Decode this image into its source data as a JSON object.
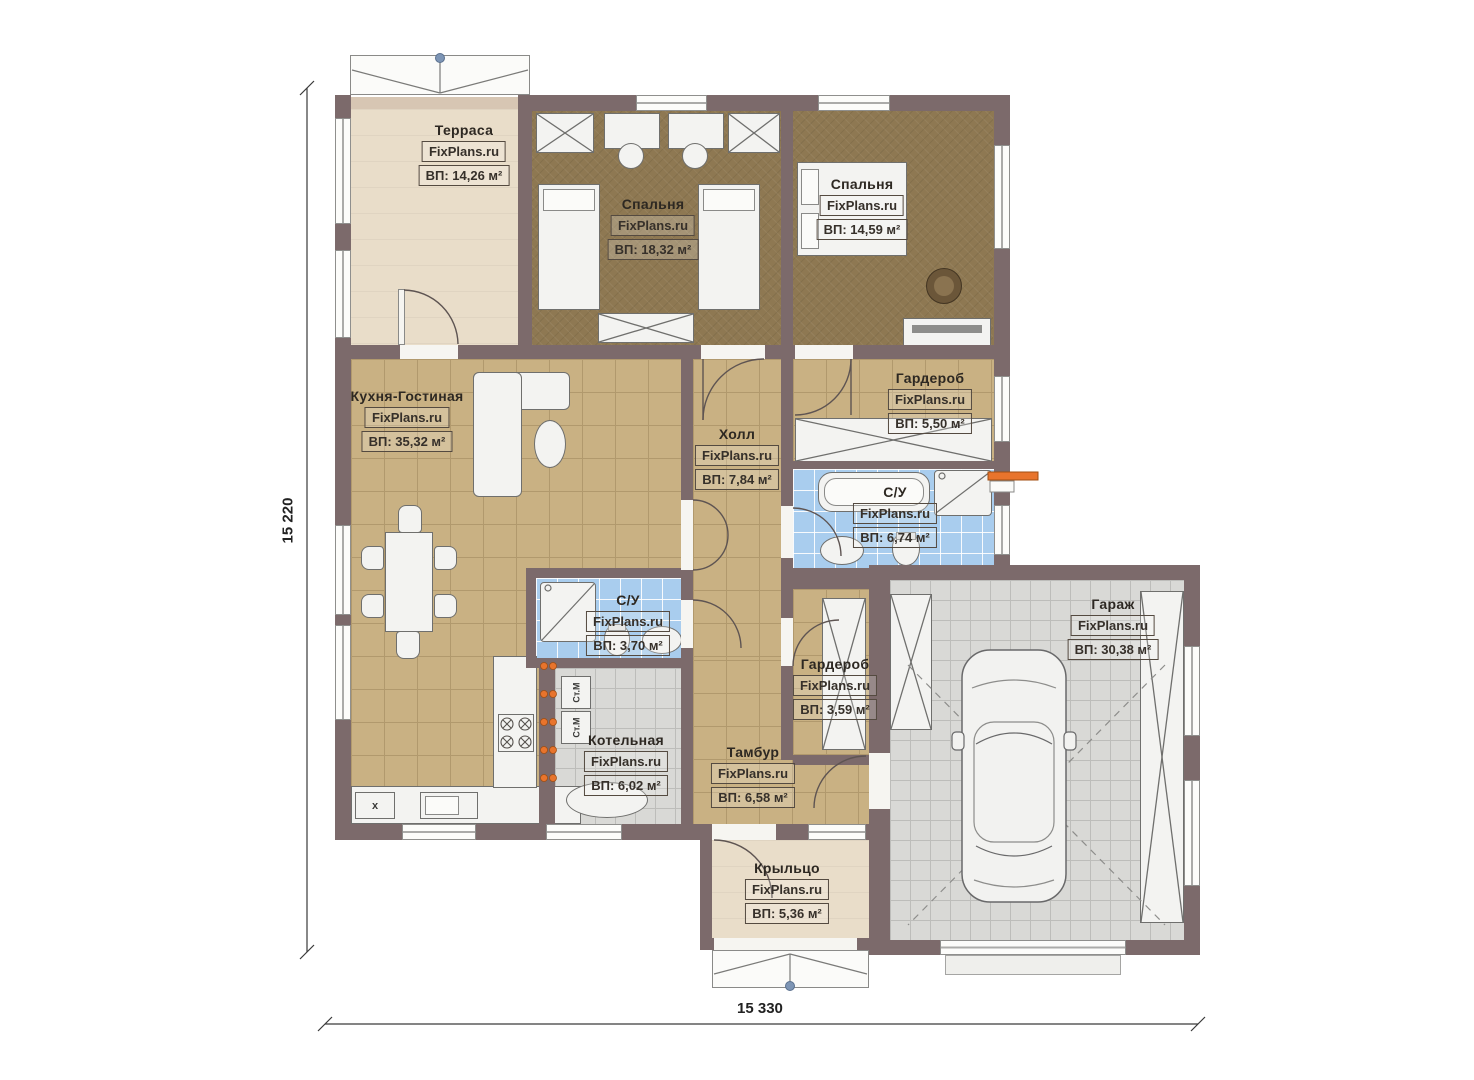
{
  "watermark": "FixPlans.ru",
  "dimensions": {
    "left": "15 220",
    "bottom": "15 330"
  },
  "rooms": {
    "terrace": {
      "label": "Терраса",
      "area": "ВП: 14,26 м²"
    },
    "bedroom1": {
      "label": "Спальня",
      "area": "ВП: 18,32 м²"
    },
    "bedroom2": {
      "label": "Спальня",
      "area": "ВП: 14,59 м²"
    },
    "kitchen_living": {
      "label": "Кухня-Гостиная",
      "area": "ВП: 35,32 м²"
    },
    "hall": {
      "label": "Холл",
      "area": "ВП: 7,84 м²"
    },
    "wardrobe_top": {
      "label": "Гардероб",
      "area": "ВП: 5,50 м²"
    },
    "bathroom_main": {
      "label": "С/У",
      "area": "ВП: 6,74 м²"
    },
    "bathroom_small": {
      "label": "С/У",
      "area": "ВП: 3,70 м²"
    },
    "wardrobe_bottom": {
      "label": "Гардероб",
      "area": "ВП: 3,59 м²"
    },
    "boiler": {
      "label": "Котельная",
      "area": "ВП: 6,02 м²"
    },
    "vestibule": {
      "label": "Тамбур",
      "area": "ВП: 6,58 м²"
    },
    "garage": {
      "label": "Гараж",
      "area": "ВП: 30,38 м²"
    },
    "porch": {
      "label": "Крыльцо",
      "area": "ВП: 5,36 м²"
    }
  },
  "appliances": {
    "washer1": "Ст.М",
    "washer2": "Ст.М",
    "x_mark": "х"
  },
  "colors": {
    "wall": "#7c6a6b",
    "bedroom_floor": "#8e7852",
    "kitchen_floor": "#c9b183",
    "bath_floor": "#a9cdee",
    "garage_floor": "#d9d9d6",
    "terrace_floor": "#e9ddc9",
    "accent_orange": "#e8742c",
    "marker_blue": "#7d95b5"
  }
}
